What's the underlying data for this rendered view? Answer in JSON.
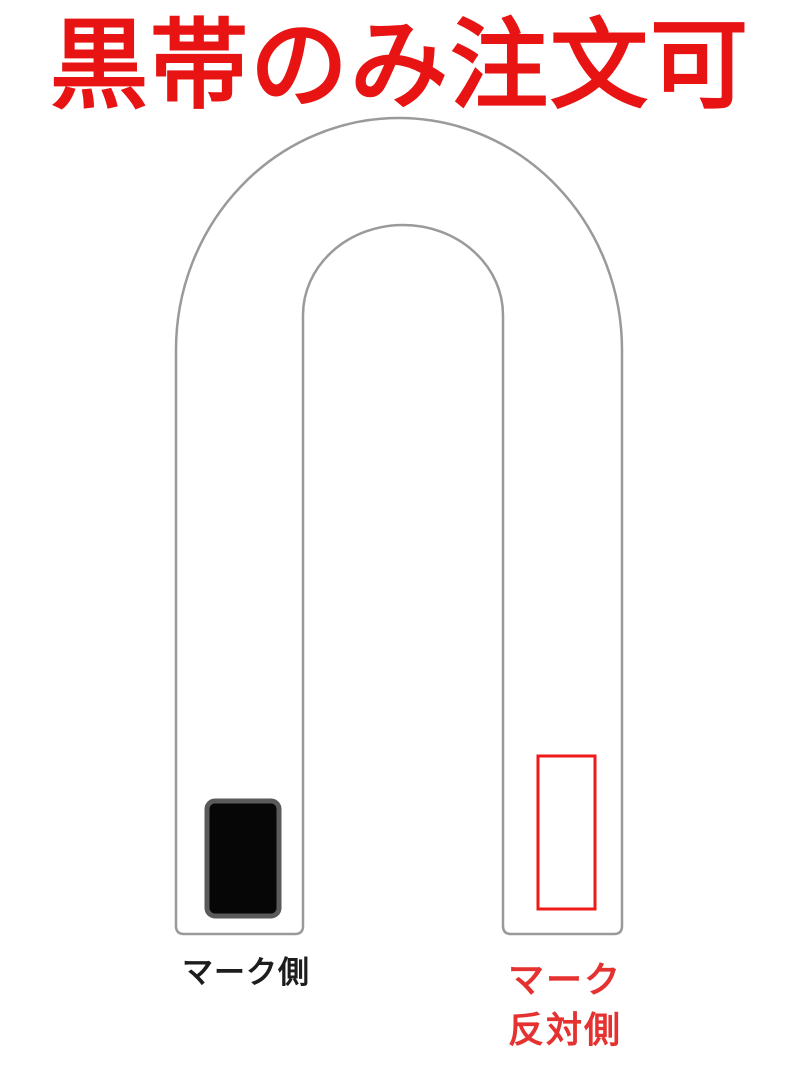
{
  "title": {
    "text": "黒帯のみ注文可",
    "color": "#e81414"
  },
  "belt": {
    "description": "folded-belt-u-shape-outline",
    "outline_color": "#9a9a9a",
    "fill": "#ffffff"
  },
  "mark_side": {
    "label": "マーク側",
    "label_color": "#1d1d1d",
    "patch": "black-filled-rectangle",
    "patch_fill": "#060606",
    "patch_border": "#5a5a5a"
  },
  "mark_opposite_side": {
    "label_line1": "マーク",
    "label_line2": "反対側",
    "label_color": "#e5312f",
    "patch": "red-outlined-rectangle",
    "patch_stroke": "#ee1a1a"
  }
}
